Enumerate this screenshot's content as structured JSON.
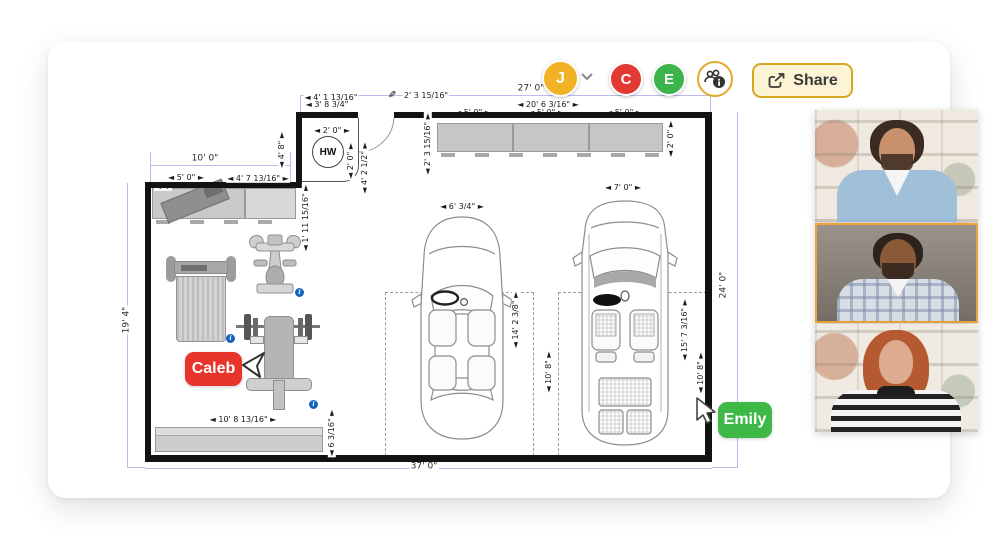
{
  "toolbar": {
    "avatars": [
      {
        "initial": "J",
        "color": "#F1B226",
        "has_dropdown": true
      },
      {
        "initial": "C",
        "color": "#E23A33",
        "has_dropdown": false
      },
      {
        "initial": "E",
        "color": "#3CB44A",
        "has_dropdown": false
      }
    ],
    "collaborators_icon": "people-info-icon",
    "share_label": "Share",
    "share_colors": {
      "bg": "#FDF4D5",
      "border": "#D9A622"
    }
  },
  "cursors": {
    "caleb": {
      "name": "Caleb",
      "color": "#E8352B"
    },
    "emily": {
      "name": "Emily",
      "color": "#3EB847"
    }
  },
  "plan": {
    "water_heater_label": "HW",
    "pencil_icon": "pencil-cursor-icon",
    "wall_color": "#121212",
    "dimension_line_color": "#B9BDEE",
    "dimension_labels": [
      {
        "text": "27' 0\"",
        "x": 531,
        "y": 89,
        "rot": 0,
        "cls": "blue"
      },
      {
        "text": "37' 0\"",
        "x": 424,
        "y": 467,
        "rot": 0,
        "cls": "blue"
      },
      {
        "text": "19' 4\"",
        "x": 127,
        "y": 320,
        "rot": -90,
        "cls": "blue"
      },
      {
        "text": "24' 0\"",
        "x": 724,
        "y": 285,
        "rot": -90,
        "cls": "blue"
      },
      {
        "text": "10' 0\"",
        "x": 205,
        "y": 159,
        "rot": 0,
        "cls": "blue"
      },
      {
        "text": "◄ 4' 8\" ►",
        "x": 282,
        "y": 150,
        "rot": -90,
        "cls": ""
      },
      {
        "text": "◄ 4' 1 13/16\"",
        "x": 331,
        "y": 98,
        "rot": 0,
        "cls": ""
      },
      {
        "text": "◄ 3' 8 3/4\"",
        "x": 327,
        "y": 105,
        "rot": 0,
        "cls": ""
      },
      {
        "text": "2' 3 15/16\"",
        "x": 426,
        "y": 96,
        "rot": 0,
        "cls": ""
      },
      {
        "text": "◄ 2' 0\" ►",
        "x": 332,
        "y": 131,
        "rot": 0,
        "cls": ""
      },
      {
        "text": "◄ 2' 0\" ►",
        "x": 351,
        "y": 161,
        "rot": -90,
        "cls": ""
      },
      {
        "text": "◄ 4' 2 1/2\" ►",
        "x": 365,
        "y": 168,
        "rot": -90,
        "cls": ""
      },
      {
        "text": "◄ 2' 3 15/16\" ►",
        "x": 428,
        "y": 144,
        "rot": -90,
        "cls": ""
      },
      {
        "text": "◄ 20' 6 3/16\" ►",
        "x": 548,
        "y": 105,
        "rot": 0,
        "cls": ""
      },
      {
        "text": "◄ 5' 0\" ►",
        "x": 473,
        "y": 113,
        "rot": 0,
        "cls": "under"
      },
      {
        "text": "◄ 5' 0\" ►",
        "x": 546,
        "y": 113,
        "rot": 0,
        "cls": "under"
      },
      {
        "text": "◄ 5' 0\" ►",
        "x": 624,
        "y": 113,
        "rot": 0,
        "cls": "under"
      },
      {
        "text": "◄ 2' 0\" ►",
        "x": 671,
        "y": 139,
        "rot": -90,
        "cls": ""
      },
      {
        "text": "◄ 6' 3/4\" ►",
        "x": 462,
        "y": 207,
        "rot": 0,
        "cls": ""
      },
      {
        "text": "◄ 7' 0\" ►",
        "x": 623,
        "y": 188,
        "rot": 0,
        "cls": ""
      },
      {
        "text": "◄ 14' 2 3/8\" ►",
        "x": 516,
        "y": 320,
        "rot": -90,
        "cls": ""
      },
      {
        "text": "◄ 10' 8\" ►",
        "x": 549,
        "y": 372,
        "rot": -90,
        "cls": ""
      },
      {
        "text": "◄ 15' 7 3/16\" ►",
        "x": 685,
        "y": 330,
        "rot": -90,
        "cls": ""
      },
      {
        "text": "◄ 10' 8\" ►",
        "x": 701,
        "y": 373,
        "rot": -90,
        "cls": ""
      },
      {
        "text": "◄ 1' 11 15/16\" ►",
        "x": 306,
        "y": 218,
        "rot": -90,
        "cls": ""
      },
      {
        "text": "◄ 5' 0\" ►",
        "x": 186,
        "y": 178,
        "rot": 0,
        "cls": ""
      },
      {
        "text": "◄ 4' 7 13/16\" ►",
        "x": 258,
        "y": 179,
        "rot": 0,
        "cls": ""
      },
      {
        "text": "◄ 4'",
        "x": 163,
        "y": 187,
        "rot": 0,
        "cls": "under"
      },
      {
        "text": "◄ 10' 8 13/16\" ►",
        "x": 243,
        "y": 420,
        "rot": 0,
        "cls": ""
      },
      {
        "text": "◄ 6 3/16\" ►",
        "x": 332,
        "y": 433,
        "rot": -90,
        "cls": ""
      }
    ]
  },
  "video_call": {
    "participants": [
      {
        "id": "participant-1",
        "highlighted": false,
        "palette": {
          "bg": "#EFE9DF",
          "hair": "#3B2B21",
          "skin": "#C9906C",
          "shirt": "#9FC0D8"
        }
      },
      {
        "id": "participant-2",
        "highlighted": true,
        "palette": {
          "bg": "#8F8780",
          "hair": "#2E231C",
          "skin": "#8A5A38",
          "shirt": "#D7DDE4"
        }
      },
      {
        "id": "participant-3",
        "highlighted": false,
        "palette": {
          "bg": "#EFEBE3",
          "hair": "#B55A30",
          "skin": "#DCAB90",
          "shirt": "#E9E9E9"
        }
      }
    ]
  }
}
